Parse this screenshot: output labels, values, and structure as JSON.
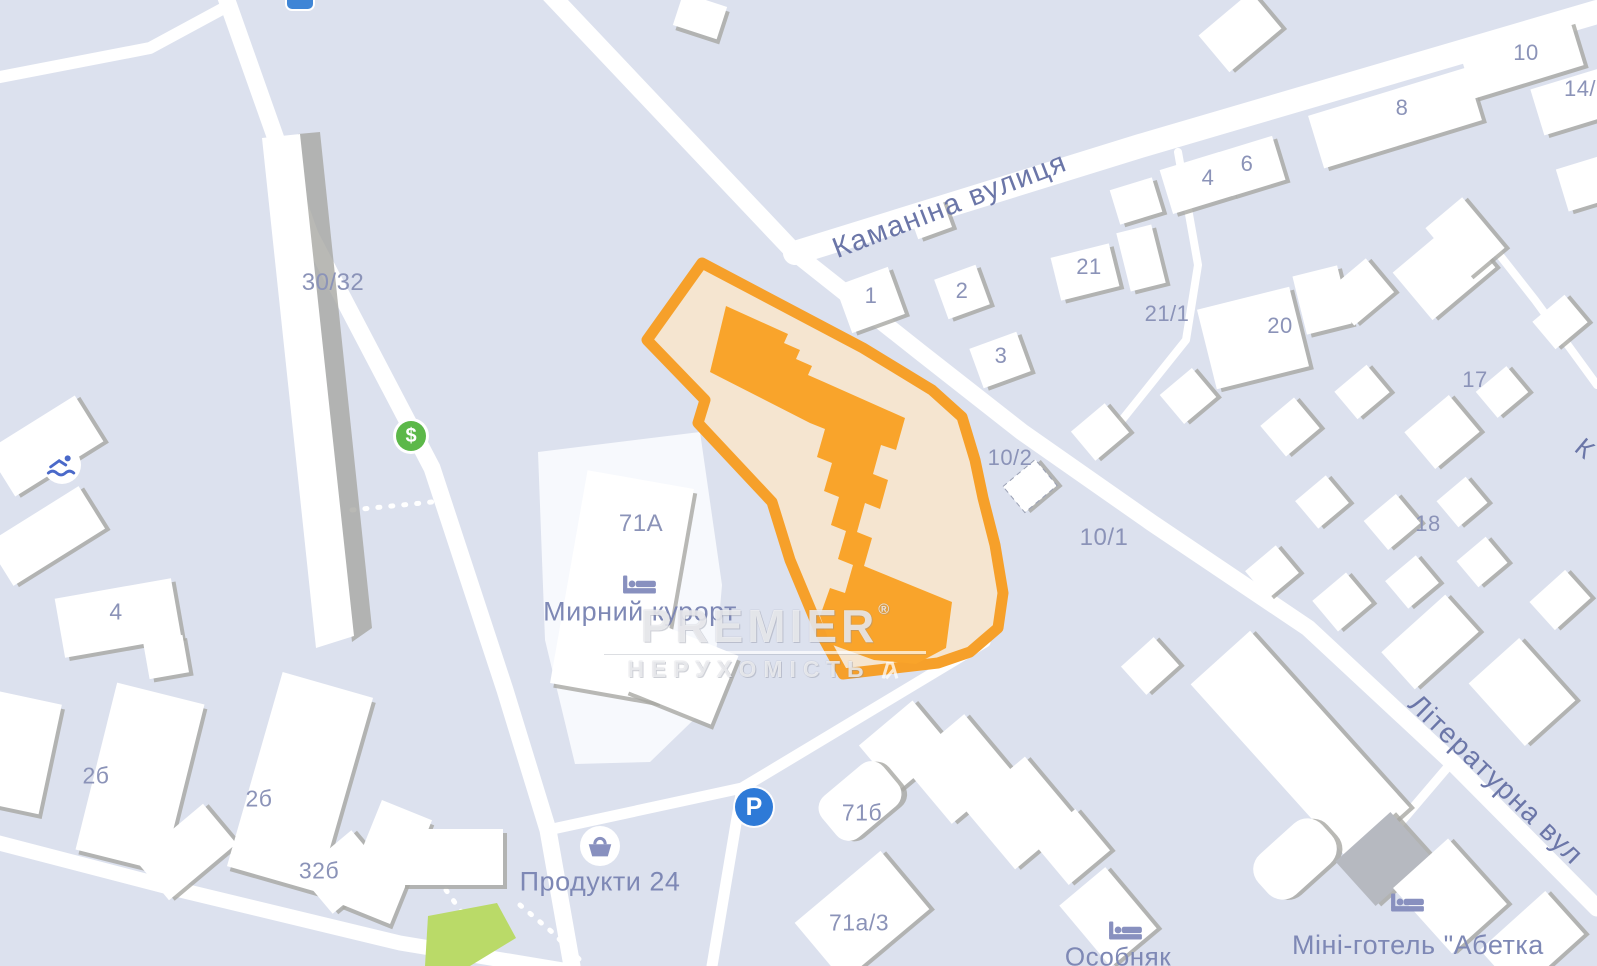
{
  "map": {
    "streets": [
      "Каманіна вулиця",
      "Літературна вул",
      "К"
    ],
    "house_numbers": [
      "30/32",
      "4",
      "2б",
      "2б",
      "32б",
      "71А",
      "71б",
      "71а/3",
      "1",
      "2",
      "3",
      "21",
      "21/1",
      "20",
      "17",
      "18",
      "10/2",
      "10/1",
      "4",
      "6",
      "8",
      "10",
      "14/"
    ],
    "places": [
      {
        "label": "Мирний курорт",
        "icon": "bed-icon"
      },
      {
        "label": "Продукти 24",
        "icon": "shopping-basket-icon"
      },
      {
        "label": "Особняк",
        "icon": "bed-icon"
      },
      {
        "label": "Міні-готель \"Абетка",
        "icon": "bed-icon"
      }
    ],
    "poi": {
      "parking": {
        "glyph": "P"
      },
      "atm": {
        "glyph": "$"
      },
      "swimming": {
        "name": "swimming-icon"
      }
    },
    "watermark": {
      "brand": "PREMIER",
      "registered": "®",
      "subtitle": "НЕРУХОМІСТЬ"
    },
    "colors": {
      "background": "#DCE1EE",
      "road": "#FFFFFF",
      "building": "#FFFFFF",
      "building_shadow": "#A7A8A2",
      "selection_outline": "#F6A02A",
      "selection_fill": "#F5E5CD",
      "selected_building": "#F9A42B",
      "parking_blue": "#2E7AD7",
      "atm_green": "#5CB849",
      "park_green": "#BADA68",
      "street_label": "#6B76A8",
      "number_label": "#8B93B8"
    }
  }
}
